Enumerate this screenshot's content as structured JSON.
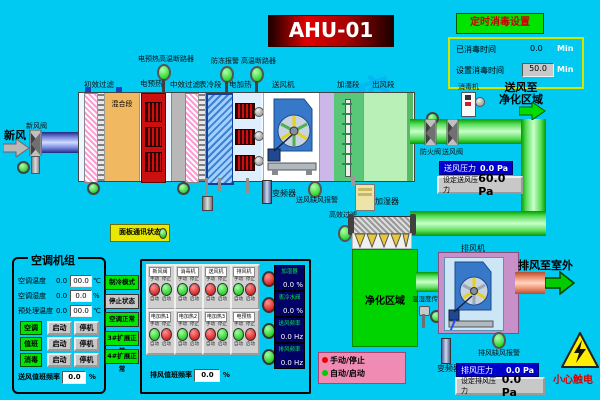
{
  "header": {
    "title": "AHU-01",
    "disinfect_button": "定时消毒设置",
    "elapsed_label": "已消毒时间",
    "elapsed_value": "0.0",
    "elapsed_unit": "Min",
    "set_label": "设置消毒时间",
    "set_value": "50.0",
    "set_unit": "Min"
  },
  "watermark": "华东工控",
  "ahu": {
    "fresh_air_label": "新风",
    "fresh_valve_label": "新风阀",
    "top_sensors": [
      "电预热高温断路器",
      "防冻报警",
      "高温断路器"
    ],
    "section_labels": [
      "初效过滤",
      "电预热",
      "中效过滤",
      "表冷段",
      "电加热",
      "送风机",
      "加湿段",
      "出风段"
    ],
    "mixing_label": "混合段",
    "vfd_label": "变频器",
    "supply_alarm_label": "送风缺风报警",
    "humidifier_label": "加湿器",
    "comm_button": "面板通讯状态"
  },
  "supply": {
    "disinfector_label": "消毒机",
    "to_clean_line1": "送风至",
    "to_clean_line2": "净化区域",
    "fire_valve_label": "防火阀",
    "supply_valve_label": "送风阀",
    "pressure_label": "送风压力",
    "pressure_value": "0.0 Pa",
    "set_pressure_label": "设定送风压力",
    "set_pressure_value": "60.0 Pa"
  },
  "clean": {
    "hepa_label": "高效过滤",
    "area_label": "净化区域",
    "sensor_label": "温湿度传感器",
    "exhaust_fan_label": "排风机",
    "to_outdoor_label": "排风至室外",
    "exhaust_vfd_label": "变频器",
    "exhaust_alarm_label": "排风缺风报警",
    "pressure_label": "排风压力",
    "pressure_value": "0.0 Pa",
    "set_pressure_label": "设定排风压力",
    "set_pressure_value": "0.0 Pa",
    "warning_label": "小心触电"
  },
  "unit_panel": {
    "title": "空调机组",
    "rows": [
      {
        "label": "空调温度",
        "value": "0.0",
        "box": "00.0",
        "unit": "℃"
      },
      {
        "label": "空调湿度",
        "value": "0.0",
        "box": "0.0",
        "unit": "%"
      },
      {
        "label": "预处理温度",
        "value": "0.0",
        "box": "00.0",
        "unit": "℃"
      }
    ],
    "modes": [
      {
        "name": "空调",
        "start": "启动",
        "stop": "停机"
      },
      {
        "name": "值班",
        "start": "启动",
        "stop": "停机"
      },
      {
        "name": "消毒",
        "start": "启动",
        "stop": "停机"
      }
    ],
    "duty_label": "送风值班频率",
    "duty_value": "0.0",
    "duty_unit": "%"
  },
  "status_column": [
    {
      "text": "制冷模式",
      "state": "green"
    },
    {
      "text": "停止状态",
      "state": "gray"
    },
    {
      "text": "空调正常",
      "state": "green"
    },
    {
      "text": "3#扩展正常",
      "state": "green"
    },
    {
      "text": "4#扩展正常",
      "state": "green"
    }
  ],
  "device_panel": {
    "mini_top_left": "手动",
    "mini_top_right": "停止",
    "mini_bottom_left": "自动",
    "mini_bottom_right": "启动",
    "indicators": [
      {
        "label": "新风阀",
        "left": "red",
        "right": "green"
      },
      {
        "label": "消毒机",
        "left": "green",
        "right": "red"
      },
      {
        "label": "送风机",
        "left": "red",
        "right": "green"
      },
      {
        "label": "排风机",
        "left": "green",
        "right": "red"
      },
      {
        "label": "电加热1",
        "left": "green",
        "right": "red"
      },
      {
        "label": "电加热2",
        "left": "green",
        "right": "red"
      },
      {
        "label": "电加热3",
        "left": "red",
        "right": "green"
      },
      {
        "label": "电预热",
        "left": "green",
        "right": "red"
      }
    ],
    "analog": [
      {
        "label": "加湿器",
        "value": "0.0 %",
        "light": "red"
      },
      {
        "label": "表冷水阀",
        "value": "0.0 %",
        "light": "red"
      },
      {
        "label": "送风频率",
        "value": "0.0 Hz",
        "light": "green"
      },
      {
        "label": "排风频率",
        "value": "0.0 Hz",
        "light": "green"
      }
    ],
    "duty_label": "排风值班频率",
    "duty_value": "0.0",
    "duty_unit": "%"
  },
  "legend": [
    {
      "color": "#ee0000",
      "text": "手动/停止"
    },
    {
      "color": "#00cc00",
      "text": "自动/启动"
    }
  ]
}
